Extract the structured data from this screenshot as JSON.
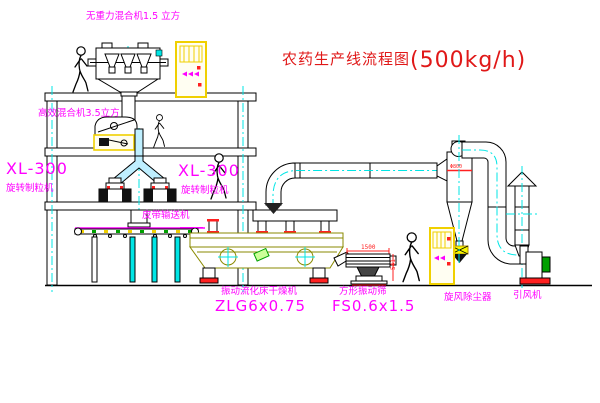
{
  "title": {
    "main": "农药生产线流程图",
    "capacity": "(500kg/h)"
  },
  "labels": {
    "mixer_top": "无重力混合机1.5 立方",
    "mixer_mid": "高效混合机3.5立方",
    "granulator_model_left": "XL-300",
    "granulator_name_left": "旋转制粒机",
    "granulator_model_right": "XL-300",
    "granulator_name_right": "旋转制粒机",
    "belt_conveyor": "皮带输送机",
    "dryer_name": "振动流化床干燥机",
    "dryer_model": "ZLG6x0.75",
    "sieve_name": "方形振动筛",
    "sieve_model": "FS0.6x1.5",
    "cyclone": "旋风除尘器",
    "fan": "引风机"
  },
  "dimensions": {
    "sieve_width": "1500",
    "sieve_height": "541",
    "cyclone_dia": "Φ800"
  },
  "colors": {
    "label_magenta": "#FF00FF",
    "title_red": "#E01818",
    "cad_cyan": "#00E5E5",
    "cad_yellow": "#F0D000",
    "dryer_olive": "#8A8A00",
    "motor_green": "#00A000",
    "flange_red": "#FF2020"
  }
}
